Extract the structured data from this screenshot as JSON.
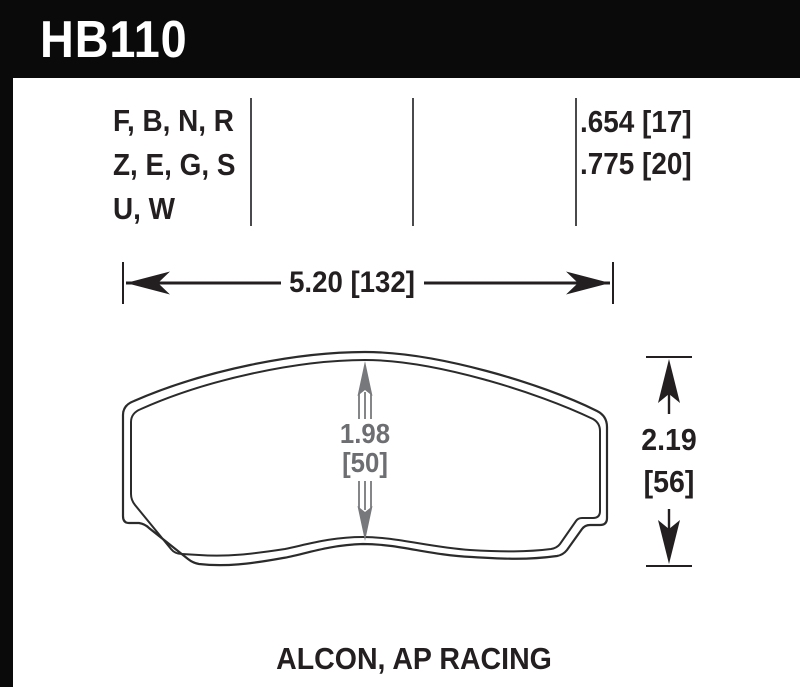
{
  "header": {
    "part_number": "HB110"
  },
  "fitment": {
    "compound_lines": [
      "F, B, N, R",
      "Z, E, G, S",
      "U, W"
    ],
    "thickness_lines": [
      ".654 [17]",
      ".775 [20]"
    ]
  },
  "dimensions": {
    "width_label": "5.20 [132]",
    "pad_depth_line1": "1.98",
    "pad_depth_line2": "[50]",
    "height_line1": "2.19",
    "height_line2": "[56]"
  },
  "footer": {
    "applications": "ALCON, AP RACING"
  },
  "colors": {
    "ink": "#231f20",
    "dimension_gray": "#6d6e71",
    "header_bg": "#0a0a0a"
  }
}
